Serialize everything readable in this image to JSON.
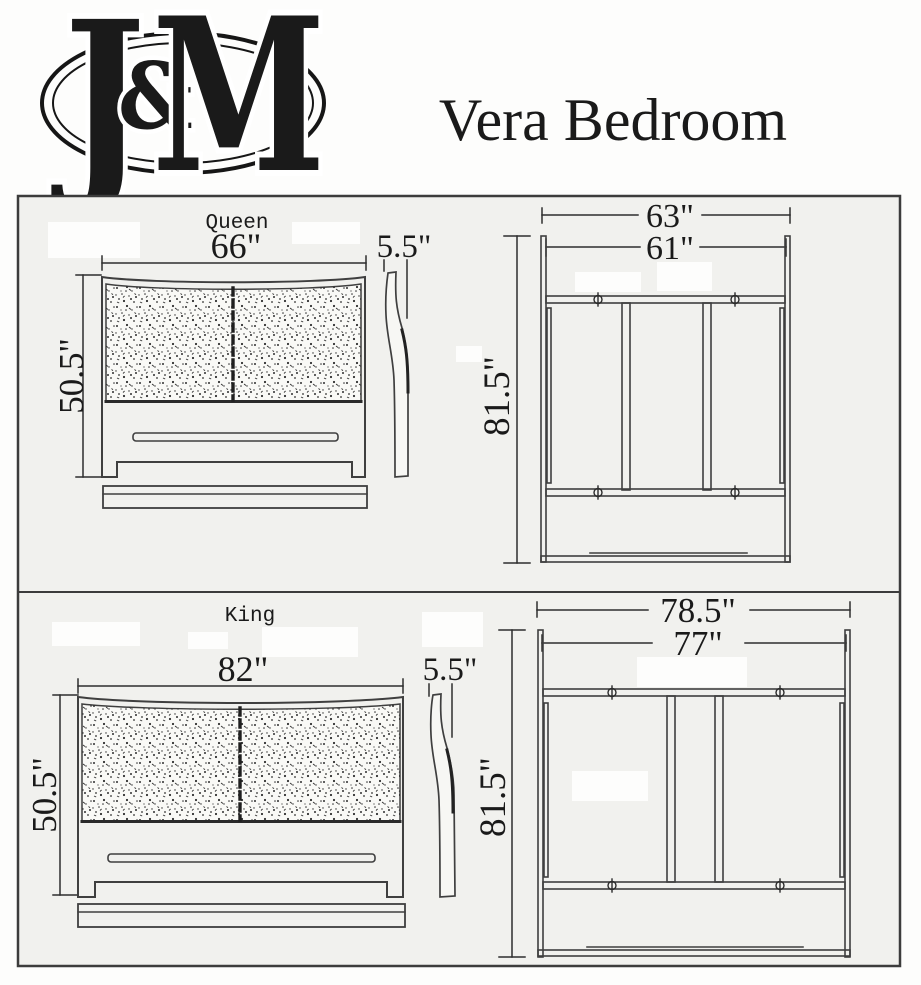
{
  "header": {
    "logo_letters": [
      "J",
      "&",
      "M"
    ],
    "title": "Vera Bedroom"
  },
  "queen": {
    "label": "Queen",
    "headboard_width": "66\"",
    "headboard_height": "50.5\"",
    "headboard_depth": "5.5\"",
    "frame_outer_width": "63\"",
    "frame_inner_width": "61\"",
    "frame_length": "81.5\""
  },
  "king": {
    "label": "King",
    "headboard_width": "82\"",
    "headboard_height": "50.5\"",
    "headboard_depth": "5.5\"",
    "frame_outer_width": "78.5\"",
    "frame_inner_width": "77\"",
    "frame_length": "81.5\""
  },
  "colors": {
    "line": "#3f3f3f",
    "ink": "#1a1a1a",
    "panel_bg": "#f1f1ee",
    "page_bg": "#fdfdfc"
  }
}
